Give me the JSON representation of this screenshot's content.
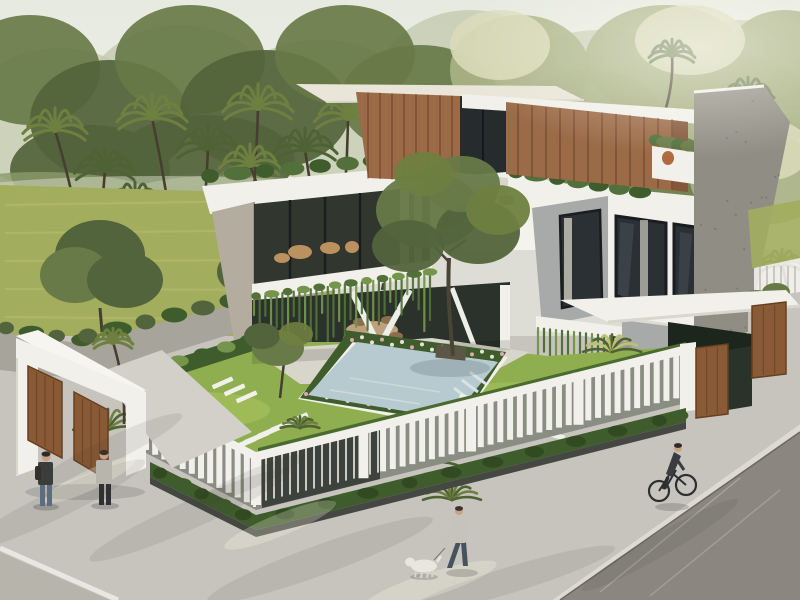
{
  "scene": {
    "type": "3d-architectural-rendering",
    "subject": "modern two-story tropical villa with courtyard pool",
    "elements": [
      "sky",
      "background-trees",
      "palm-grove",
      "meadow",
      "boundary-wall",
      "entrance-gate",
      "wooden-pivot-doors",
      "white-slatted-fence",
      "perimeter-hedge",
      "garden",
      "swimming-pool",
      "stepping-stones",
      "courtyard-tree",
      "balcony",
      "hanging-vines",
      "wood-clad-upper-floor",
      "glass-windows",
      "roof-garden",
      "carport-canopy",
      "side-gate",
      "sidewalk",
      "asphalt-road",
      "pedestrians",
      "dog-walker",
      "dog",
      "cyclist"
    ]
  },
  "palette": {
    "sky": "#eceee6",
    "haze": "#dde1d4",
    "sun": "#fdfcf3",
    "treeDark": "#52643c",
    "treeMid": "#687a48",
    "treeLight": "#a9b286",
    "treeHaze": "#c2c8ab",
    "treeBright": "#dadcbb",
    "trunk": "#463f30",
    "palmFrond": "#4e6234",
    "palmLight": "#6e8040",
    "lawnBack": "#a3ad5e",
    "lawnLight": "#bcc26e",
    "lawnYard": "#8fae50",
    "lawnYardLight": "#a8c35e",
    "white": "#f1f0ea",
    "whiteShade": "#d9d6ce",
    "cream": "#e9e5d8",
    "concrete": "#b4ad9f",
    "stone": "#a8aaa9",
    "wallGray": "#8f8d84",
    "wood": "#9b6a47",
    "woodDark": "#7c5136",
    "woodSeam": "#6d4027",
    "woodGate": "#8a5a36",
    "woodGateDark": "#66401f",
    "glass": "#2b3034",
    "glassLight": "#47525a",
    "frame": "#1a1d1f",
    "vine": "#52703a",
    "vineLight": "#74954a",
    "hedge": "#3f5c2c",
    "hedgeDark": "#324a22",
    "planter": "#454842",
    "pool": "#b6cad0",
    "poolLight": "#d8e3e4",
    "pavement": "#c7c4be",
    "paveShade": "#b3b0a9",
    "paveLight": "#d6d3cb",
    "deck": "#d8d5ca",
    "interior": "#2c322c",
    "roadDark": "#8b8780",
    "roadLeft": "#b7b4ac",
    "lineWhite": "#e9e7e1",
    "curb": "#dcdad2",
    "skin": "#c9a183",
    "denim": "#5c6d80",
    "darkCloth": "#3b3d38",
    "grayCloth": "#b8b5ad",
    "blackCloth": "#2f3134",
    "dogWhite": "#e9e6df",
    "bike": "#2d2f31",
    "terracotta": "#b06a42"
  }
}
